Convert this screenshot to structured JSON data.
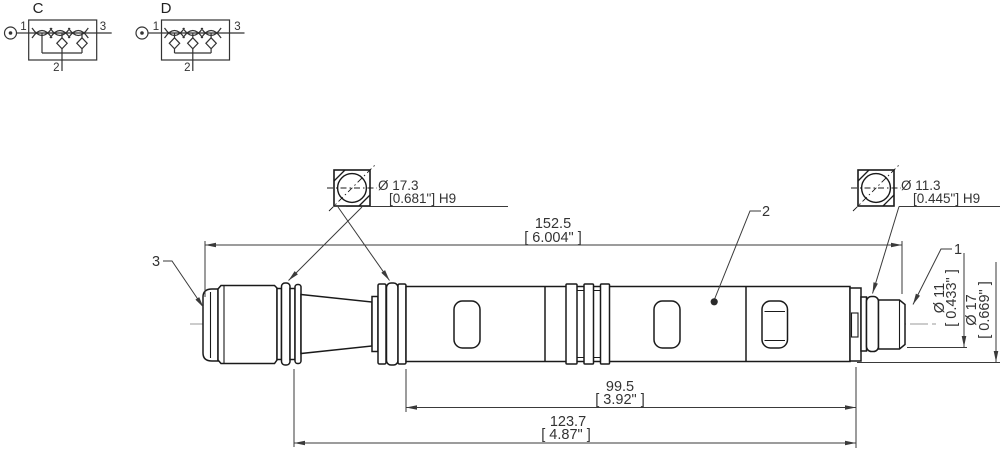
{
  "schematic_c": {
    "label": "C",
    "pin_1": "1",
    "pin_2": "2",
    "pin_3": "3"
  },
  "schematic_d": {
    "label": "D",
    "pin_1": "1",
    "pin_2": "2",
    "pin_3": "3"
  },
  "callout_left": {
    "diameter": "Ø 17.3",
    "tolerance": "[0.681\"] H9"
  },
  "callout_right": {
    "diameter": "Ø 11.3",
    "tolerance": "[0.445\"] H9"
  },
  "dim_overall": {
    "mm": "152.5",
    "inch": "[ 6.004\" ]"
  },
  "dim_probe": {
    "mm": "99.5",
    "inch": "[ 3.92\" ]"
  },
  "dim_mount": {
    "mm": "123.7",
    "inch": "[ 4.87\" ]"
  },
  "dim_tip_dia": {
    "mm": "Ø 11",
    "inch": "[ 0.433\" ]"
  },
  "dim_body_dia": {
    "mm": "Ø 17",
    "inch": "[ 0.669\" ]"
  },
  "labels": {
    "connector_end": "3",
    "sensor_body": "2",
    "probe_tip": "1"
  },
  "colors": {
    "outline": "#1a1a1a",
    "dimension": "#3a3a3a",
    "centerline": "#999999",
    "background": "#ffffff"
  }
}
